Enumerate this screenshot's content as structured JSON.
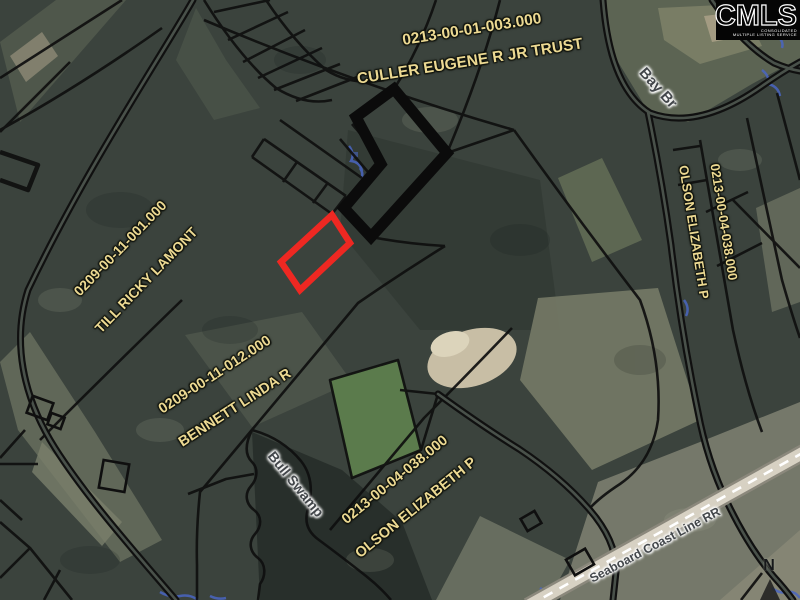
{
  "logo": {
    "brand": "CMLS",
    "tagline_line1": "CONSOLIDATED",
    "tagline_line2": "MULTIPLE LISTING SERVICE"
  },
  "labels": {
    "culler_number": "0213-00-01-003.000",
    "culler_owner": "CULLER EUGENE R JR TRUST",
    "olson_east_number": "0213-00-04-038.000",
    "olson_east_owner": "OLSON ELIZABETH P",
    "till_number": "0209-00-11-001.000",
    "till_owner": "TILL RICKY LAMONT",
    "bennett_number": "0209-00-11-012.000",
    "bennett_owner": "BENNETT LINDA R",
    "olson_south_number": "0213-00-04-038.000",
    "olson_south_owner": "OLSON ELIZABETH P",
    "bay_branch": "Bay Br",
    "bull_swamp": "Bull Swamp",
    "railroad": "Seaboard Coast Line RR",
    "north": "N"
  },
  "colors": {
    "highlight_red": "#ee2822",
    "highlight_black": "#0b0b0b",
    "parcel_line": "#0f0f0f",
    "label_yellow": "#ecd992",
    "rail_band": "#d7d1c3"
  }
}
